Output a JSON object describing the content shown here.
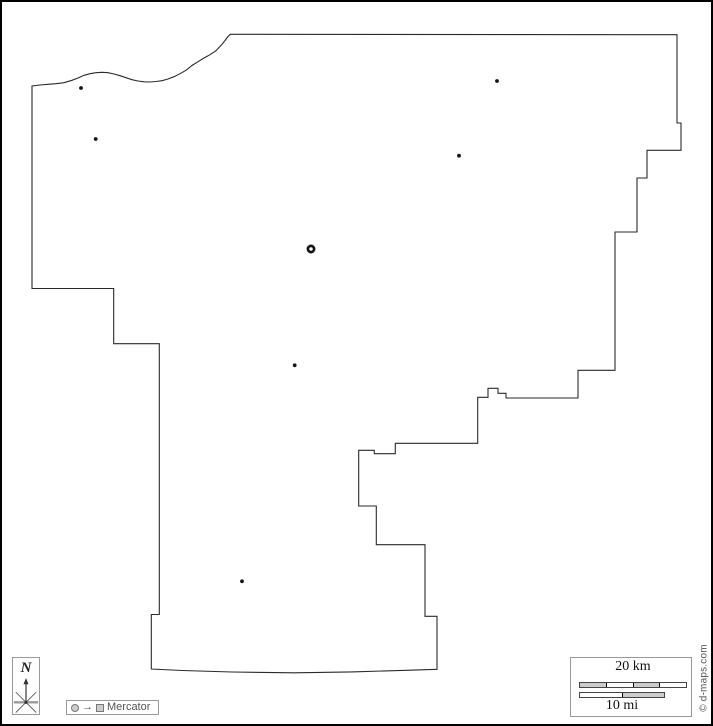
{
  "map": {
    "description": "blank county outline map",
    "outline_color": "#2a2a2a",
    "background": "#ffffff",
    "dot_color": "#151515",
    "outline_points": [
      [
        30,
        84
      ],
      [
        30,
        286.5
      ],
      [
        111.7,
        286.5
      ],
      [
        111.7,
        341.7
      ],
      [
        157.3,
        341.7
      ],
      [
        157.3,
        612.5
      ],
      [
        149.3,
        612.5
      ],
      [
        149.3,
        667
      ],
      [
        180,
        668.5
      ],
      [
        230,
        670
      ],
      [
        292,
        670.8
      ],
      [
        350,
        669.9
      ],
      [
        400,
        668.4
      ],
      [
        435,
        667.3
      ],
      [
        435,
        614.3
      ],
      [
        423,
        614.3
      ],
      [
        423,
        542.7
      ],
      [
        374.3,
        542.7
      ],
      [
        374.3,
        504
      ],
      [
        356.7,
        504
      ],
      [
        356.7,
        448.3
      ],
      [
        372.3,
        448.3
      ],
      [
        372.3,
        451.7
      ],
      [
        393.3,
        451.7
      ],
      [
        393.3,
        441.3
      ],
      [
        475.7,
        441.3
      ],
      [
        475.7,
        395.3
      ],
      [
        486,
        395.3
      ],
      [
        486,
        386.3
      ],
      [
        496,
        386.3
      ],
      [
        496,
        391.3
      ],
      [
        504,
        391.3
      ],
      [
        504,
        396
      ],
      [
        576,
        396
      ],
      [
        576,
        368.3
      ],
      [
        613,
        368.3
      ],
      [
        613,
        230
      ],
      [
        635,
        230
      ],
      [
        635,
        176
      ],
      [
        645,
        176
      ],
      [
        645,
        148.3
      ],
      [
        679,
        148.3
      ],
      [
        679,
        121
      ],
      [
        675,
        121
      ],
      [
        675,
        32.7
      ],
      [
        228.3,
        32.3
      ],
      [
        226,
        34.5
      ],
      [
        223,
        38.5
      ],
      [
        220,
        42.3
      ],
      [
        214,
        48.7
      ],
      [
        208,
        52.7
      ],
      [
        202,
        56
      ],
      [
        196,
        59.7
      ],
      [
        190,
        63.5
      ],
      [
        184,
        68.3
      ],
      [
        178,
        71.7
      ],
      [
        172,
        74.7
      ],
      [
        166,
        77
      ],
      [
        160,
        78.7
      ],
      [
        154,
        79.5
      ],
      [
        148,
        80
      ],
      [
        142,
        79.8
      ],
      [
        136,
        79
      ],
      [
        130,
        77.7
      ],
      [
        124,
        75.7
      ],
      [
        118,
        73.7
      ],
      [
        112,
        72
      ],
      [
        106,
        70.7
      ],
      [
        100,
        70.3
      ],
      [
        94,
        70.7
      ],
      [
        88,
        71.7
      ],
      [
        82,
        73.3
      ],
      [
        76,
        76
      ],
      [
        70,
        78.3
      ],
      [
        62,
        80.7
      ],
      [
        54,
        81.7
      ],
      [
        46,
        82.3
      ],
      [
        38,
        83
      ],
      [
        30,
        84
      ]
    ],
    "city_dots": [
      {
        "x": 79,
        "y": 86
      },
      {
        "x": 93.7,
        "y": 137
      },
      {
        "x": 495,
        "y": 79
      },
      {
        "x": 457,
        "y": 153.7
      },
      {
        "x": 292.7,
        "y": 363.3
      },
      {
        "x": 240,
        "y": 579.3
      }
    ],
    "county_seat": {
      "x": 309,
      "y": 247
    }
  },
  "north_indicator": {
    "label": "N"
  },
  "projection_legend": {
    "label": "Mercator",
    "arrow_glyph": "→"
  },
  "scale_bar": {
    "km_label": "20 km",
    "mi_label": "10 mi",
    "km_pattern": [
      "#cccccc",
      "#ffffff",
      "#cccccc",
      "#ffffff"
    ],
    "mi_pattern": [
      "#ffffff",
      "#cccccc"
    ],
    "segment_fill": "#cccccc"
  },
  "copyright": {
    "text": "© d-maps.com"
  }
}
